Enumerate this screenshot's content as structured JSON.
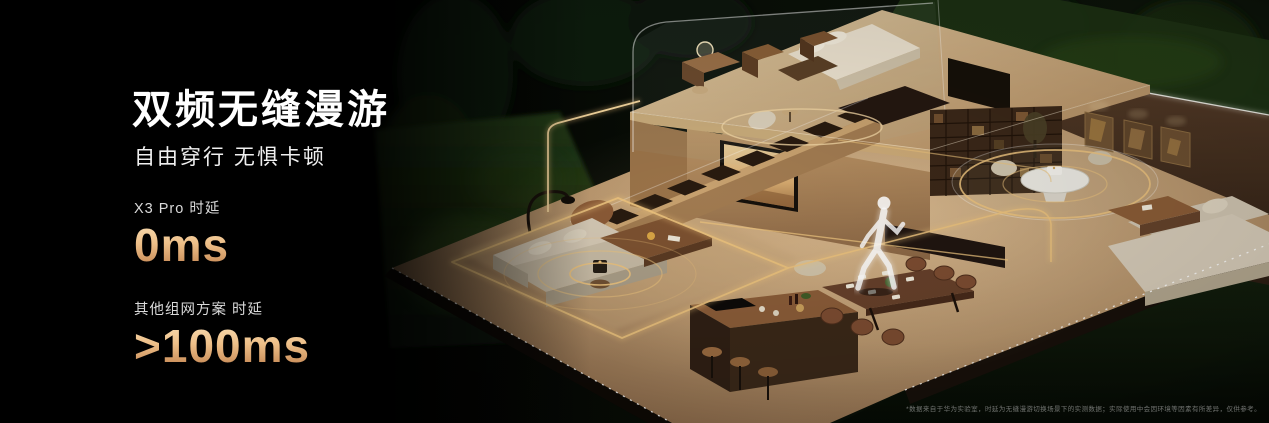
{
  "headline": {
    "title": "双频无缝漫游",
    "subtitle": "自由穿行 无惧卡顿"
  },
  "stats": [
    {
      "label": "X3 Pro 时延",
      "value": "0ms"
    },
    {
      "label": "其他组网方案 时延",
      "value": ">100ms"
    }
  ],
  "disclaimer": "*数据来自于华为实验室，时延为无缝漫游切换场景下的实测数据；实际使用中会因环境等因素有所差异，仅供参考。",
  "colors": {
    "background": "#000000",
    "headline_text": "#ffffff",
    "accent_copper_light": "#f6d9ae",
    "accent_copper_dark": "#c1824f",
    "wifi_glow_gold": "#eac17c",
    "wood_floor": "#b6946c",
    "wall_brown": "#402c1c",
    "foliage_green": "#16240f"
  }
}
